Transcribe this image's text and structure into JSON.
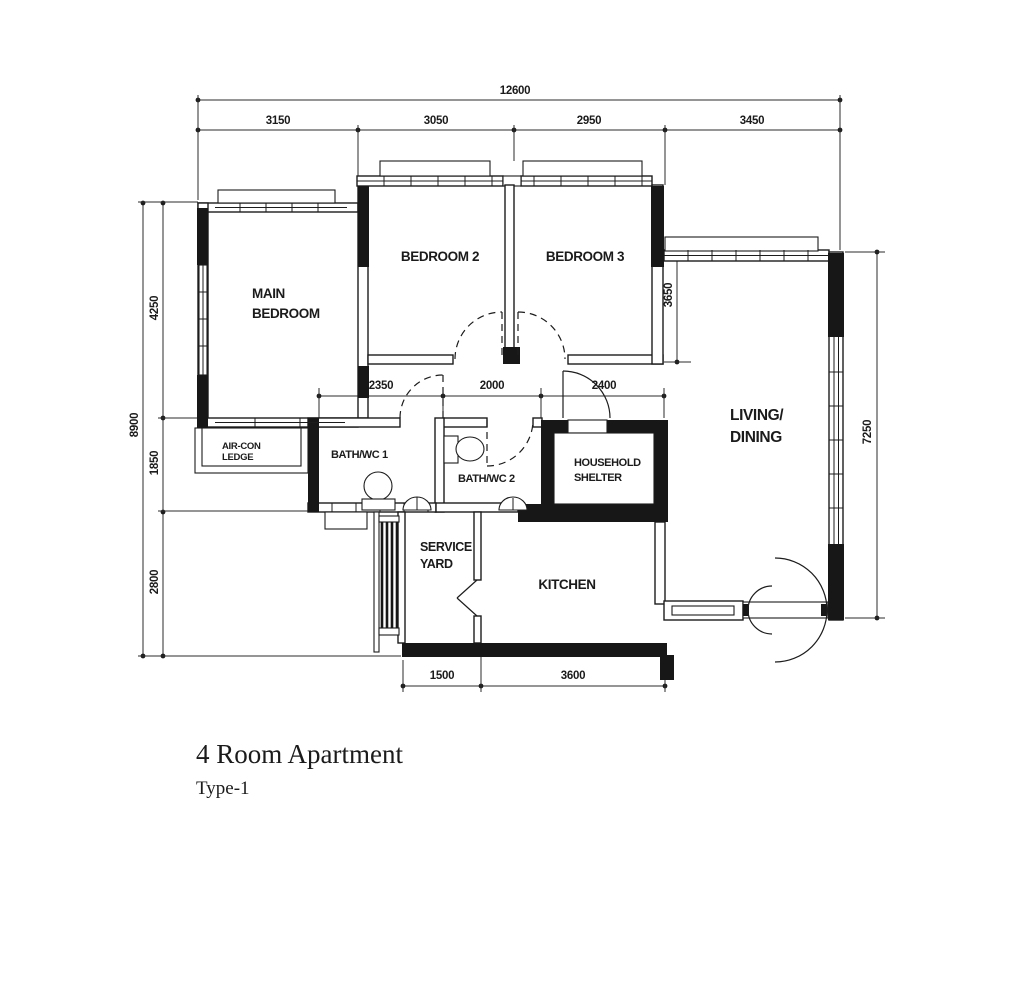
{
  "title": {
    "main": "4 Room Apartment",
    "subtitle": "Type-1"
  },
  "rooms": {
    "main_bedroom": {
      "line1": "MAIN",
      "line2": "BEDROOM"
    },
    "bedroom2": "BEDROOM 2",
    "bedroom3": "BEDROOM 3",
    "living_dining": {
      "line1": "LIVING/",
      "line2": "DINING"
    },
    "aircon_ledge": {
      "line1": "AIR-CON",
      "line2": "LEDGE"
    },
    "bath_wc_1": "BATH/WC 1",
    "bath_wc_2": "BATH/WC 2",
    "household_shelter": {
      "line1": "HOUSEHOLD",
      "line2": "SHELTER"
    },
    "service_yard": {
      "line1": "SERVICE",
      "line2": "YARD"
    },
    "kitchen": "KITCHEN"
  },
  "dimensions": {
    "overall_width": "12600",
    "top": [
      "3150",
      "3050",
      "2950",
      "3450"
    ],
    "overall_height": "8900",
    "left": [
      "4250",
      "1850",
      "2800"
    ],
    "right": [
      "3650",
      "7250"
    ],
    "middle": [
      "2350",
      "2000",
      "2400"
    ],
    "bottom": [
      "1500",
      "3600"
    ]
  },
  "colors": {
    "ink": "#1c1c1c",
    "background": "#ffffff"
  }
}
